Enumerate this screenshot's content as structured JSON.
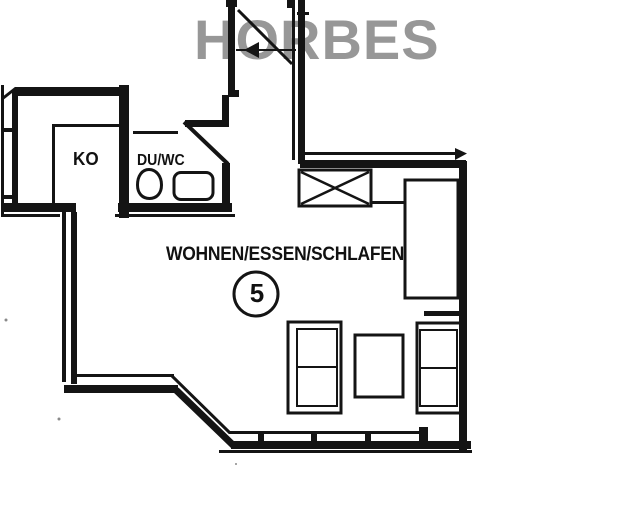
{
  "watermark": {
    "text": "HORBES",
    "color": "#8f8f8f"
  },
  "rooms": {
    "kitchen": {
      "label": "KO"
    },
    "bathroom": {
      "label": "DU/WC"
    },
    "living_room": {
      "label": "WOHNEN/ESSEN/SCHLAFEN",
      "unit_number": "5"
    }
  },
  "symbols": {
    "chimney_shaft": "x-crossed-box",
    "toilet": "oval-bowl",
    "sink": "rounded-rectangle",
    "wardrobe": "open-rectangle",
    "sofas": "double-rectangle-with-divider",
    "coffee_table": "rectangle",
    "entrance_door": "diagonal-leaf-with-left-arrow",
    "bathroom_door": "diagonal-leaf",
    "windows": "double-line-with-ticks"
  },
  "colors": {
    "line": "#141414",
    "background": "#ffffff",
    "watermark_gray": "#8f8f8f"
  }
}
